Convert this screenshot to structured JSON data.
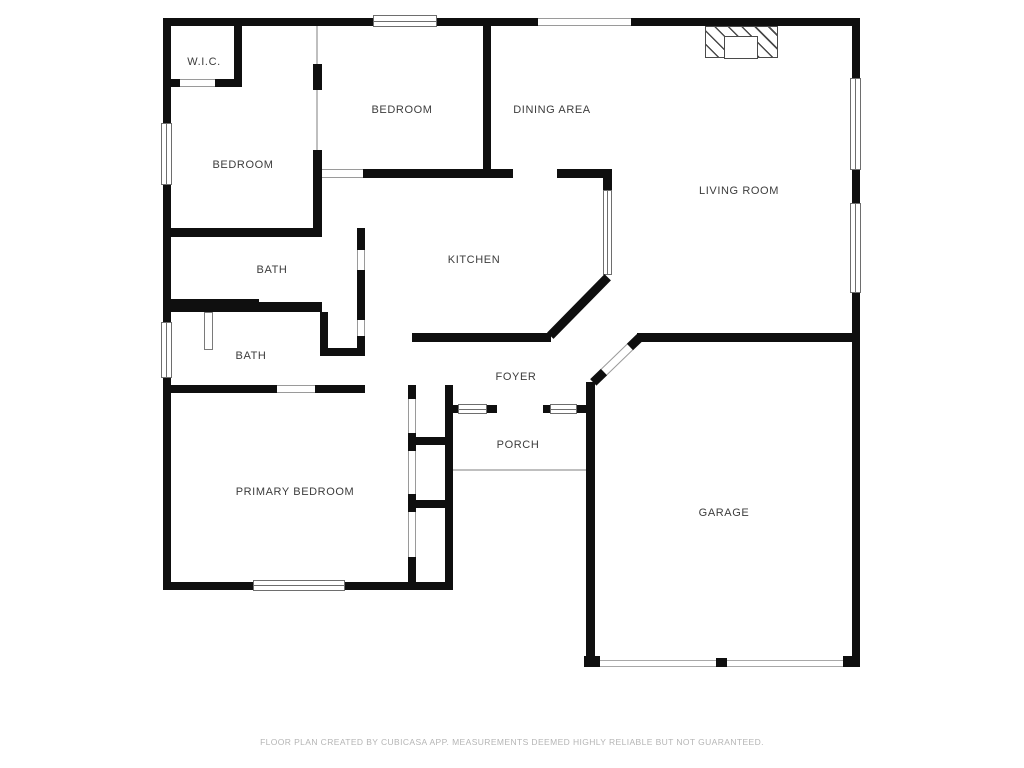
{
  "rooms": [
    {
      "id": "wic",
      "label": "W.I.C."
    },
    {
      "id": "bedroom-left",
      "label": "BEDROOM"
    },
    {
      "id": "bedroom-top",
      "label": "BEDROOM"
    },
    {
      "id": "dining-area",
      "label": "DINING AREA"
    },
    {
      "id": "living-room",
      "label": "LIVING ROOM"
    },
    {
      "id": "kitchen",
      "label": "KITCHEN"
    },
    {
      "id": "bath-upper",
      "label": "BATH"
    },
    {
      "id": "bath-lower",
      "label": "BATH"
    },
    {
      "id": "foyer",
      "label": "FOYER"
    },
    {
      "id": "porch",
      "label": "PORCH"
    },
    {
      "id": "primary-bedroom",
      "label": "PRIMARY BEDROOM"
    },
    {
      "id": "garage",
      "label": "GARAGE"
    }
  ],
  "footer": {
    "disclaimer": "FLOOR PLAN CREATED BY CUBICASA APP. MEASUREMENTS DEEMED HIGHLY RELIABLE BUT NOT GUARANTEED."
  },
  "colors": {
    "background": "#ffffff",
    "wall": "#0f0f0f",
    "label": "#3c3c3c",
    "footer_text": "#b5b5b5",
    "window_line": "#6e6e6e",
    "opening_line": "#9a9a9a"
  }
}
